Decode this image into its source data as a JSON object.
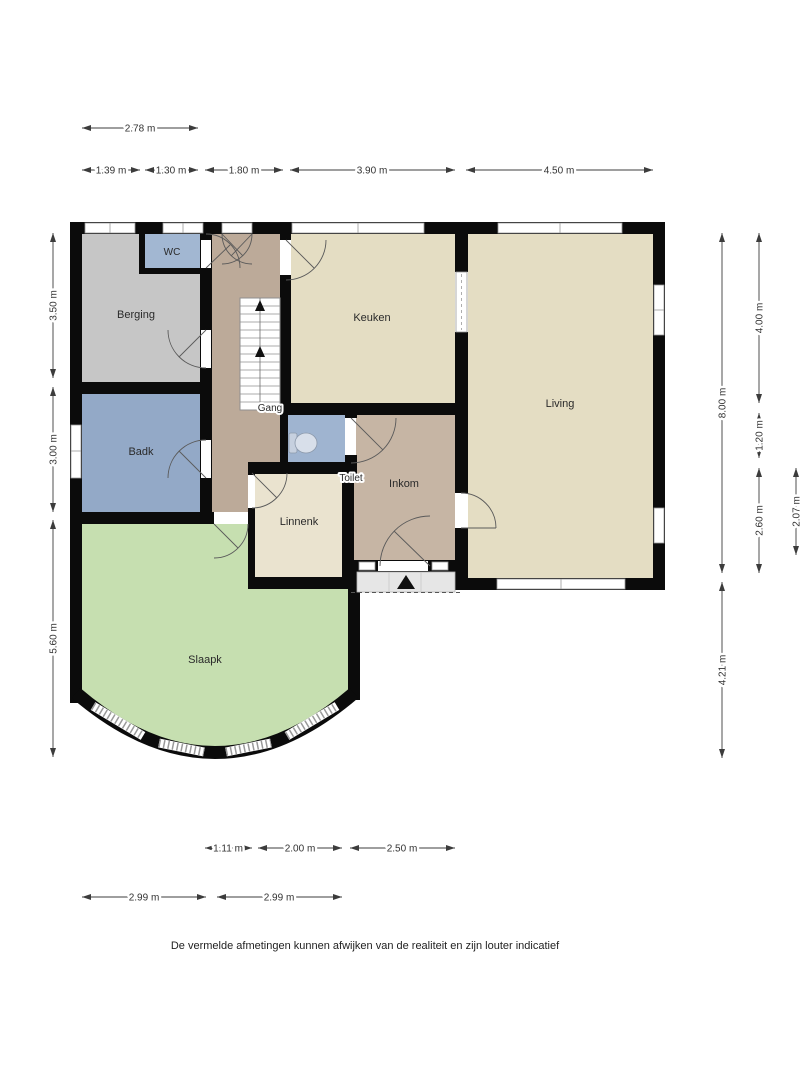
{
  "plan": {
    "rooms": {
      "wc": {
        "label": "WC"
      },
      "berging": {
        "label": "Berging"
      },
      "badk": {
        "label": "Badk"
      },
      "gang": {
        "label": "Gang"
      },
      "keuken": {
        "label": "Keuken"
      },
      "living": {
        "label": "Living"
      },
      "toilet": {
        "label": "Toilet"
      },
      "inkom": {
        "label": "Inkom"
      },
      "linnenk": {
        "label": "Linnenk"
      },
      "slaapk": {
        "label": "Slaapk"
      }
    },
    "colors": {
      "wall": "#0b0b0b",
      "keuken": "#e4ddc3",
      "living": "#e4ddc3",
      "linnenk": "#eae3cf",
      "gang": "#bcaa99",
      "inkom": "#c6b5a4",
      "berging": "#c6c6c6",
      "wc": "#a2b7d2",
      "badk": "#93a9c7",
      "toilet": "#9fb4d0",
      "slaapk": "#c6dfb0",
      "porch": "#e6e6e6"
    },
    "dimensions": {
      "top_overall": "2.78 m",
      "top_segments": [
        "1.39 m",
        "1.30 m",
        "1.80 m",
        "3.90 m",
        "4.50 m"
      ],
      "left_segments": [
        "3.50 m",
        "3.00 m",
        "5.60 m"
      ],
      "right_overall": [
        "8.00 m",
        "4.21 m"
      ],
      "right_segments": [
        "4.00 m",
        "1.20 m",
        "2.60 m"
      ],
      "right_inner": [
        "2.07 m"
      ],
      "bottom_segments": [
        "1.11 m",
        "2.00 m",
        "2.50 m"
      ],
      "bottom_overall": [
        "2.99 m",
        "2.99 m"
      ]
    },
    "disclaimer": "De vermelde afmetingen kunnen afwijken van de realiteit en zijn louter indicatief"
  }
}
